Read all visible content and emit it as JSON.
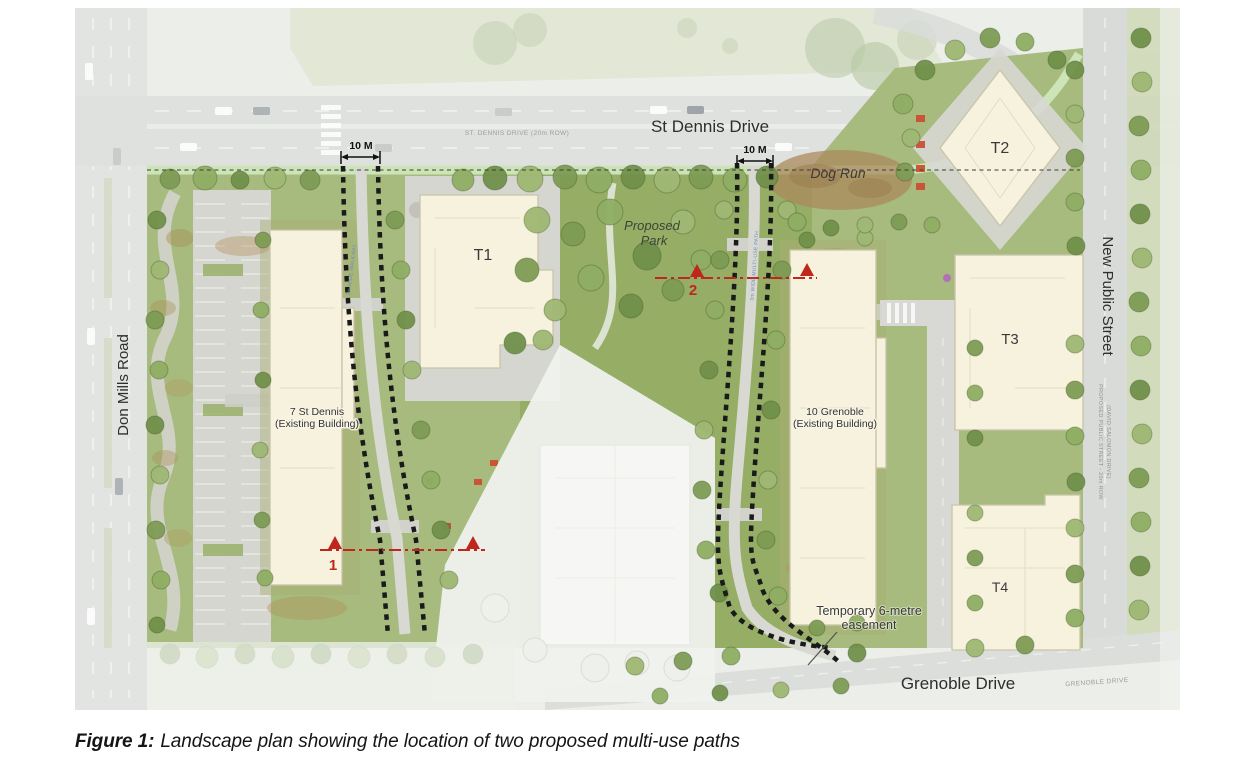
{
  "figure": {
    "caption_prefix": "Figure 1:",
    "caption_text": "Landscape plan showing the location of two proposed multi-use paths"
  },
  "plan": {
    "streets": {
      "st_dennis": "St Dennis Drive",
      "st_dennis_small": "ST. DENNIS DRIVE (20m ROW)",
      "don_mills": "Don Mills Road",
      "new_public": "New Public Street",
      "new_public_small_1": "PROPOSED PUBLIC STREET - 20m ROW",
      "new_public_small_2": "(DAVID SALOMON DRIVE)",
      "grenoble": "Grenoble Drive",
      "grenoble_small": "GRENOBLE DRIVE"
    },
    "areas": {
      "proposed_park_1": "Proposed",
      "proposed_park_2": "Park",
      "dog_run": "Dog Run",
      "easement_1": "Temporary 6-metre",
      "easement_2": "easement"
    },
    "buildings": {
      "t1": "T1",
      "t2": "T2",
      "t3": "T3",
      "t4": "T4",
      "b7_1": "7 St Dennis",
      "b7_2": "(Existing Building)",
      "b10_1": "10 Grenoble",
      "b10_2": "(Existing Building)"
    },
    "dimensions": {
      "left": "10 M",
      "right": "10 M"
    },
    "path_labels": {
      "left": "3m WIDE WALKWAY",
      "right": "3m WIDE MULTI-USE PATH"
    },
    "sections": {
      "s1": "1",
      "s2": "2"
    },
    "colors": {
      "grass": "#a7bb7e",
      "park_green": "#95ad65",
      "building_fill": "#f6f2dd",
      "road_gray": "#dcdedb",
      "dash_black": "#1a1a1a",
      "section_red": "#c0271c",
      "bike_lane_green": "#cfe5bc",
      "dog_run_brown": "#ab8a5d"
    }
  }
}
